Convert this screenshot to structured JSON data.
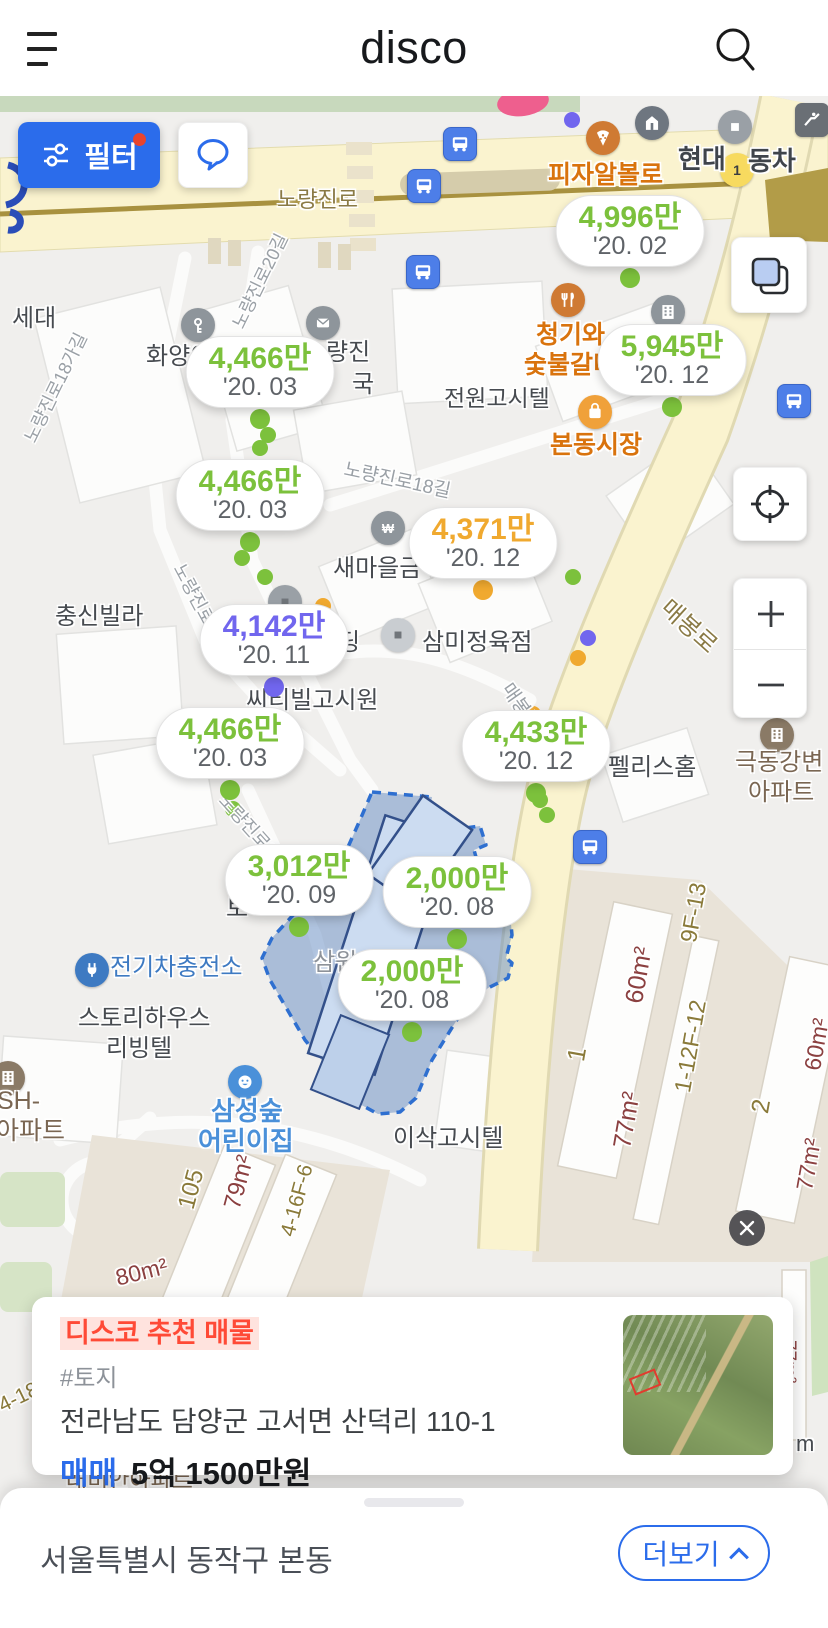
{
  "colors": {
    "green": "#7cc13c",
    "orange": "#f0a92f",
    "purple": "#7166ee",
    "blue": "#5a78e8"
  },
  "header": {
    "logo": "disco"
  },
  "map": {
    "filter_button": {
      "label": "필터"
    },
    "price_bubbles": [
      {
        "price": "4,996만",
        "date": "'20. 02",
        "color": "green",
        "x": 630,
        "y": 231
      },
      {
        "price": "5,945만",
        "date": "'20. 12",
        "color": "green",
        "x": 672,
        "y": 360
      },
      {
        "price": "4,466만",
        "date": "'20. 03",
        "color": "green",
        "x": 260,
        "y": 372
      },
      {
        "price": "4,466만",
        "date": "'20. 03",
        "color": "green",
        "x": 250,
        "y": 495
      },
      {
        "price": "4,371만",
        "date": "'20. 12",
        "color": "orange",
        "x": 483,
        "y": 543
      },
      {
        "price": "4,142만",
        "date": "'20. 11",
        "color": "purple",
        "x": 274,
        "y": 640
      },
      {
        "price": "4,466만",
        "date": "'20. 03",
        "color": "green",
        "x": 230,
        "y": 743
      },
      {
        "price": "4,433만",
        "date": "'20. 12",
        "color": "green",
        "x": 536,
        "y": 746
      },
      {
        "price": "3,012만",
        "date": "'20. 09",
        "color": "green",
        "x": 299,
        "y": 880
      },
      {
        "price": "2,000만",
        "date": "'20. 08",
        "color": "green",
        "x": 457,
        "y": 892
      },
      {
        "price": "2,000만",
        "date": "'20. 08",
        "color": "green",
        "x": 412,
        "y": 985
      }
    ],
    "marker_dots": [
      {
        "x": 268,
        "y": 435,
        "color": "green"
      },
      {
        "x": 260,
        "y": 448,
        "color": "green"
      },
      {
        "x": 242,
        "y": 558,
        "color": "green"
      },
      {
        "x": 265,
        "y": 577,
        "color": "green"
      },
      {
        "x": 573,
        "y": 577,
        "color": "green"
      },
      {
        "x": 233,
        "y": 809,
        "color": "green"
      },
      {
        "x": 540,
        "y": 800,
        "color": "green"
      },
      {
        "x": 547,
        "y": 815,
        "color": "green"
      },
      {
        "x": 323,
        "y": 606,
        "color": "orange"
      },
      {
        "x": 578,
        "y": 658,
        "color": "orange"
      },
      {
        "x": 533,
        "y": 714,
        "color": "orange"
      },
      {
        "x": 588,
        "y": 638,
        "color": "purple"
      },
      {
        "x": 572,
        "y": 120,
        "color": "purple"
      }
    ],
    "pois": [
      {
        "name": "key",
        "icon": "key",
        "x": 198,
        "y": 325,
        "bg": "#8e959b"
      },
      {
        "name": "post-office",
        "icon": "envelope",
        "x": 323,
        "y": 323,
        "bg": "#8e959b"
      },
      {
        "name": "bank-won",
        "icon": "won",
        "x": 388,
        "y": 528,
        "bg": "#8e959b"
      },
      {
        "name": "office-building",
        "icon": "building",
        "x": 668,
        "y": 312,
        "bg": "#8e959b"
      },
      {
        "name": "landmark",
        "icon": "landmark",
        "x": 652,
        "y": 123,
        "bg": "#6e7680"
      },
      {
        "name": "car-dealer",
        "icon": "square-white",
        "x": 735,
        "y": 127,
        "bg": "#9aa0a6"
      },
      {
        "name": "route-badge-1",
        "icon": "one",
        "x": 737,
        "y": 170,
        "bg": "#f7da5f"
      },
      {
        "name": "pizza-restaurant",
        "icon": "pizza",
        "x": 603,
        "y": 138,
        "bg": "#cf7a33"
      },
      {
        "name": "restaurant",
        "icon": "cutlery",
        "x": 568,
        "y": 300,
        "bg": "#cf7a33"
      },
      {
        "name": "market",
        "icon": "bag",
        "x": 595,
        "y": 412,
        "bg": "#f0a13a"
      },
      {
        "name": "butcher-shop",
        "icon": "square-dark",
        "x": 398,
        "y": 635,
        "bg": "#c9cdd1"
      },
      {
        "name": "shop",
        "icon": "square-dark",
        "x": 285,
        "y": 602,
        "bg": "#9aa0a6"
      },
      {
        "name": "ev-charging-station",
        "icon": "plug",
        "x": 92,
        "y": 970,
        "bg": "#3e7ac2"
      },
      {
        "name": "daycare",
        "icon": "smiley",
        "x": 245,
        "y": 1082,
        "bg": "#4a90d9"
      },
      {
        "name": "apartment",
        "icon": "building",
        "x": 777,
        "y": 735,
        "bg": "#8a7a66"
      },
      {
        "name": "apartment",
        "icon": "building",
        "x": 8,
        "y": 1078,
        "bg": "#8a7a66"
      },
      {
        "name": "subway-exit",
        "icon": "escalator",
        "x": 812,
        "y": 120,
        "bg": "#6a6f75",
        "shape": "square"
      }
    ],
    "bus_stops": [
      [
        460,
        144
      ],
      [
        424,
        186
      ],
      [
        423,
        272
      ],
      [
        794,
        401
      ],
      [
        590,
        847
      ]
    ],
    "labels": [
      {
        "t": "노량진로",
        "x": 277,
        "y": 188,
        "c": "#8a7a45",
        "s": 22
      },
      {
        "t": "피자알볼로",
        "x": 548,
        "y": 162,
        "c": "#d9730d",
        "s": 25,
        "w": 700
      },
      {
        "t": "현대",
        "x": 678,
        "y": 146,
        "c": "#3f444b",
        "s": 26,
        "w": 600
      },
      {
        "t": "동차",
        "x": 748,
        "y": 148,
        "c": "#3f444b",
        "s": 26,
        "w": 600
      },
      {
        "t": "청기와",
        "x": 536,
        "y": 322,
        "c": "#d9730d",
        "s": 25,
        "w": 700
      },
      {
        "t": "숯불갈비",
        "x": 524,
        "y": 352,
        "c": "#d9730d",
        "s": 25,
        "w": 700
      },
      {
        "t": "본동시장",
        "x": 550,
        "y": 432,
        "c": "#d9730d",
        "s": 25,
        "w": 700
      },
      {
        "t": "전원고시텔",
        "x": 444,
        "y": 386,
        "c": "#474b50",
        "s": 23
      },
      {
        "t": "량진",
        "x": 326,
        "y": 340,
        "c": "#474b50",
        "s": 24
      },
      {
        "t": "국",
        "x": 352,
        "y": 372,
        "c": "#474b50",
        "s": 24
      },
      {
        "t": "화양이",
        "x": 146,
        "y": 344,
        "c": "#474b50",
        "s": 24
      },
      {
        "t": "세대",
        "x": 12,
        "y": 306,
        "c": "#474b50",
        "s": 24
      },
      {
        "t": "새마을금",
        "x": 333,
        "y": 556,
        "c": "#474b50",
        "s": 24
      },
      {
        "t": "충신빌라",
        "x": 55,
        "y": 604,
        "c": "#474b50",
        "s": 24
      },
      {
        "t": "딩",
        "x": 338,
        "y": 630,
        "c": "#474b50",
        "s": 24
      },
      {
        "t": "삼미정육점",
        "x": 422,
        "y": 630,
        "c": "#474b50",
        "s": 24
      },
      {
        "t": "씨티빌고시원",
        "x": 246,
        "y": 688,
        "c": "#474b50",
        "s": 24
      },
      {
        "t": "펠리스홈",
        "x": 608,
        "y": 755,
        "c": "#474b50",
        "s": 24
      },
      {
        "t": "극동강변",
        "x": 735,
        "y": 750,
        "c": "#7a6652",
        "s": 24
      },
      {
        "t": "아파트",
        "x": 748,
        "y": 780,
        "c": "#7a6652",
        "s": 24
      },
      {
        "t": "전기차충전소",
        "x": 110,
        "y": 955,
        "c": "#3e7ac2",
        "s": 24
      },
      {
        "t": "스토리하우스",
        "x": 78,
        "y": 1006,
        "c": "#474b50",
        "s": 24
      },
      {
        "t": "리빙텔",
        "x": 106,
        "y": 1036,
        "c": "#474b50",
        "s": 24
      },
      {
        "t": "동SH-",
        "x": -26,
        "y": 1088,
        "c": "#7a6652",
        "s": 25
      },
      {
        "t": "아파트",
        "x": -4,
        "y": 1118,
        "c": "#7a6652",
        "s": 25
      },
      {
        "t": "삼성숲",
        "x": 211,
        "y": 1098,
        "c": "#4a90d9",
        "s": 26,
        "w": 600
      },
      {
        "t": "어린이집",
        "x": 198,
        "y": 1128,
        "c": "#4a90d9",
        "s": 26,
        "w": 600
      },
      {
        "t": "이삭고시텔",
        "x": 393,
        "y": 1126,
        "c": "#474b50",
        "s": 24
      },
      {
        "t": "토",
        "x": 226,
        "y": 896,
        "c": "#474b50",
        "s": 24
      },
      {
        "t": "삼원",
        "x": 313,
        "y": 950,
        "c": "#8d9299",
        "s": 24
      },
      {
        "t": "래미안아파트",
        "x": 66,
        "y": 1468,
        "c": "#7a6652",
        "s": 23
      },
      {
        "t": "m",
        "x": 796,
        "y": 1432,
        "c": "#474b50",
        "s": 22
      },
      {
        "t": "매봉로",
        "x": 664,
        "y": 592,
        "c": "#8a7a45",
        "s": 24,
        "r": 42
      },
      {
        "t": "매봉로",
        "x": 505,
        "y": 676,
        "c": "#9aa0a6",
        "s": 19,
        "r": 55
      },
      {
        "t": "노량진로18길",
        "x": 344,
        "y": 460,
        "c": "#9aa0a6",
        "s": 19,
        "r": 12
      },
      {
        "t": "노량진로20길",
        "x": 238,
        "y": 318,
        "c": "#9aa0a6",
        "s": 18,
        "r": -64
      },
      {
        "t": "노량진로18가길",
        "x": 30,
        "y": 432,
        "c": "#9aa0a6",
        "s": 18,
        "r": -64
      },
      {
        "t": "노량진로22길",
        "x": 222,
        "y": 788,
        "c": "#9aa0a6",
        "s": 18,
        "r": 48
      },
      {
        "t": "노량진로2",
        "x": 178,
        "y": 556,
        "c": "#9aa0a6",
        "s": 18,
        "r": 62
      },
      {
        "t": "105",
        "x": 186,
        "y": 1196,
        "c": "#8a7a3a",
        "s": 24,
        "r": -75
      },
      {
        "t": "79m²",
        "x": 232,
        "y": 1196,
        "c": "#8b4040",
        "s": 24,
        "r": -75
      },
      {
        "t": "4-16F-6",
        "x": 288,
        "y": 1225,
        "c": "#8a7a3a",
        "s": 21,
        "r": -75
      },
      {
        "t": "80m²",
        "x": 116,
        "y": 1266,
        "c": "#8b4040",
        "s": 23,
        "r": -14
      },
      {
        "t": "9F-13",
        "x": 688,
        "y": 930,
        "c": "#8a7a3a",
        "s": 23,
        "r": -80
      },
      {
        "t": "60m²",
        "x": 634,
        "y": 990,
        "c": "#8b4040",
        "s": 25,
        "r": -80
      },
      {
        "t": "1",
        "x": 576,
        "y": 1048,
        "c": "#8a7a3a",
        "s": 25,
        "r": -80
      },
      {
        "t": "1-12F-12",
        "x": 682,
        "y": 1080,
        "c": "#8a7a3a",
        "s": 23,
        "r": -80
      },
      {
        "t": "77m²",
        "x": 622,
        "y": 1135,
        "c": "#8b4040",
        "s": 25,
        "r": -80
      },
      {
        "t": "2",
        "x": 760,
        "y": 1100,
        "c": "#8a7a3a",
        "s": 25,
        "r": -80
      },
      {
        "t": "60m²",
        "x": 812,
        "y": 1058,
        "c": "#8b4040",
        "s": 23,
        "r": -80
      },
      {
        "t": "77m²",
        "x": 804,
        "y": 1178,
        "c": "#8b4040",
        "s": 23,
        "r": -80
      },
      {
        "t": "77m²",
        "x": 788,
        "y": 1330,
        "c": "#8b4040",
        "s": 19,
        "r": 90
      },
      {
        "t": "4-18",
        "x": 0,
        "y": 1396,
        "c": "#8a7a3a",
        "s": 21,
        "r": -26
      }
    ]
  },
  "property_card": {
    "badge": "디스코 추천 매물",
    "tag": "#토지",
    "address": "전라남도 담양군 고서면 산덕리 110-1",
    "deal_type": "매매",
    "price": "5억 1500만원"
  },
  "bottom_bar": {
    "location": "서울특별시 동작구 본동",
    "more_label": "더보기"
  }
}
